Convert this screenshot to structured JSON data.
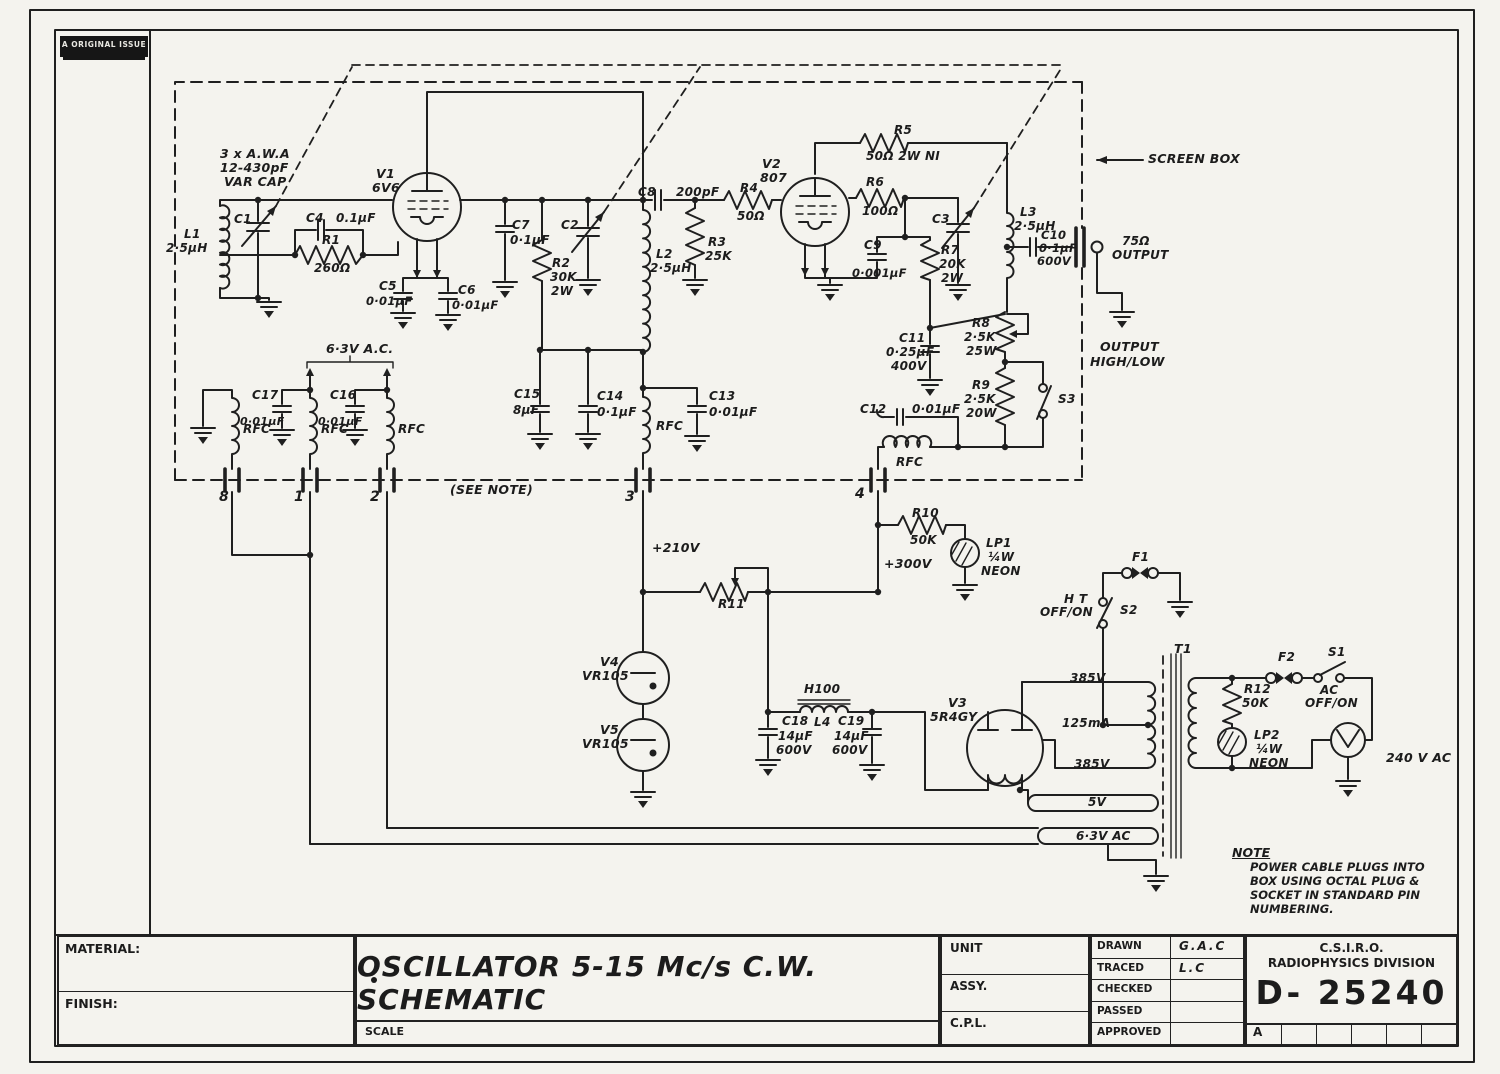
{
  "sheet": {
    "stamp": "A ORIGINAL ISSUE",
    "note": {
      "heading": "NOTE",
      "lines": [
        "POWER CABLE PLUGS INTO",
        "BOX USING OCTAL PLUG &",
        "SOCKET IN STANDARD PIN",
        "NUMBERING."
      ]
    },
    "title_block": {
      "material_label": "MATERIAL:",
      "finish_label": "FINISH:",
      "scale_label": "SCALE",
      "title": "OSCILLATOR  5-15 Mc/s C.W. SCHEMATIC",
      "unit_label": "UNIT",
      "assy_label": "ASSY.",
      "cpl_label": "C.P.L.",
      "rows": [
        {
          "label": "DRAWN",
          "value": "G.A.C"
        },
        {
          "label": "TRACED",
          "value": "L.C"
        },
        {
          "label": "CHECKED",
          "value": ""
        },
        {
          "label": "PASSED",
          "value": ""
        },
        {
          "label": "APPROVED",
          "value": ""
        }
      ],
      "org_line1": "C.S.I.R.O.",
      "org_line2": "RADIOPHYSICS DIVISION",
      "drawing_number": "D- 25240",
      "revision_cells": [
        "A",
        "",
        "",
        "",
        "",
        ""
      ]
    }
  },
  "schematic": {
    "labels": [
      {
        "t": "3 x A.W.A",
        "x": 220,
        "y": 148
      },
      {
        "t": "12-430pF",
        "x": 220,
        "y": 162
      },
      {
        "t": "VAR CAP",
        "x": 224,
        "y": 176
      },
      {
        "t": "V1",
        "x": 376,
        "y": 168
      },
      {
        "t": "6V6",
        "x": 372,
        "y": 182
      },
      {
        "t": "L1",
        "x": 184,
        "y": 228,
        "s": 12
      },
      {
        "t": "2·5μH",
        "x": 166,
        "y": 242,
        "s": 12
      },
      {
        "t": "C1",
        "x": 234,
        "y": 213,
        "s": 12
      },
      {
        "t": "C4",
        "x": 306,
        "y": 212,
        "s": 12
      },
      {
        "t": "0.1μF",
        "x": 336,
        "y": 212,
        "s": 12
      },
      {
        "t": "R1",
        "x": 322,
        "y": 234,
        "s": 12
      },
      {
        "t": "260Ω",
        "x": 314,
        "y": 262,
        "s": 12
      },
      {
        "t": "C5",
        "x": 379,
        "y": 280,
        "s": 12
      },
      {
        "t": "0·01μF",
        "x": 366,
        "y": 296,
        "s": 11.5
      },
      {
        "t": "C6",
        "x": 458,
        "y": 284,
        "s": 12
      },
      {
        "t": "0·01μF",
        "x": 452,
        "y": 300,
        "s": 11.5
      },
      {
        "t": "C7",
        "x": 512,
        "y": 219,
        "s": 12
      },
      {
        "t": "0·1μF",
        "x": 510,
        "y": 234,
        "s": 12
      },
      {
        "t": "C2",
        "x": 561,
        "y": 219,
        "s": 12
      },
      {
        "t": "R2",
        "x": 552,
        "y": 257,
        "s": 12
      },
      {
        "t": "30K",
        "x": 550,
        "y": 271,
        "s": 12
      },
      {
        "t": "2W",
        "x": 551,
        "y": 285,
        "s": 12
      },
      {
        "t": "L2",
        "x": 656,
        "y": 248,
        "s": 12
      },
      {
        "t": "2·5μH",
        "x": 650,
        "y": 262,
        "s": 12
      },
      {
        "t": "C8",
        "x": 638,
        "y": 186,
        "s": 12
      },
      {
        "t": "200pF",
        "x": 676,
        "y": 186,
        "s": 12
      },
      {
        "t": "R3",
        "x": 708,
        "y": 236,
        "s": 12
      },
      {
        "t": "25K",
        "x": 705,
        "y": 250,
        "s": 12
      },
      {
        "t": "R4",
        "x": 740,
        "y": 182,
        "s": 12
      },
      {
        "t": "50Ω",
        "x": 737,
        "y": 210,
        "s": 12
      },
      {
        "t": "V2",
        "x": 762,
        "y": 158
      },
      {
        "t": "807",
        "x": 760,
        "y": 172
      },
      {
        "t": "R5",
        "x": 894,
        "y": 124,
        "s": 12
      },
      {
        "t": "50Ω 2W NI",
        "x": 866,
        "y": 150,
        "s": 12
      },
      {
        "t": "R6",
        "x": 866,
        "y": 176,
        "s": 12
      },
      {
        "t": "100Ω",
        "x": 862,
        "y": 205,
        "s": 12
      },
      {
        "t": "C9",
        "x": 864,
        "y": 239,
        "s": 12
      },
      {
        "t": "0·001μF",
        "x": 852,
        "y": 268,
        "s": 11.5
      },
      {
        "t": "R7",
        "x": 941,
        "y": 244,
        "s": 12
      },
      {
        "t": "20K",
        "x": 939,
        "y": 258,
        "s": 12
      },
      {
        "t": "2W",
        "x": 941,
        "y": 272,
        "s": 12
      },
      {
        "t": "C3",
        "x": 932,
        "y": 213,
        "s": 12
      },
      {
        "t": "L3",
        "x": 1020,
        "y": 206,
        "s": 12
      },
      {
        "t": "2·5μH",
        "x": 1014,
        "y": 220,
        "s": 12
      },
      {
        "t": "C10",
        "x": 1041,
        "y": 230,
        "s": 11.5
      },
      {
        "t": "0·1μF",
        "x": 1039,
        "y": 243,
        "s": 11.5
      },
      {
        "t": "600V",
        "x": 1037,
        "y": 256,
        "s": 11.5
      },
      {
        "t": "75Ω",
        "x": 1122,
        "y": 235,
        "s": 12
      },
      {
        "t": "OUTPUT",
        "x": 1112,
        "y": 249,
        "s": 12
      },
      {
        "t": "SCREEN BOX",
        "x": 1148,
        "y": 153
      },
      {
        "t": "C11",
        "x": 899,
        "y": 332,
        "s": 12
      },
      {
        "t": "0·25μF",
        "x": 886,
        "y": 346,
        "s": 12
      },
      {
        "t": "400V",
        "x": 891,
        "y": 360,
        "s": 12
      },
      {
        "t": "R8",
        "x": 972,
        "y": 317,
        "s": 12
      },
      {
        "t": "2·5K",
        "x": 964,
        "y": 331,
        "s": 12
      },
      {
        "t": "25W",
        "x": 966,
        "y": 345,
        "s": 12
      },
      {
        "t": "R9",
        "x": 972,
        "y": 379,
        "s": 12
      },
      {
        "t": "2·5K",
        "x": 964,
        "y": 393,
        "s": 12
      },
      {
        "t": "20W",
        "x": 966,
        "y": 407,
        "s": 12
      },
      {
        "t": "S3",
        "x": 1058,
        "y": 393,
        "s": 12
      },
      {
        "t": "OUTPUT",
        "x": 1100,
        "y": 341
      },
      {
        "t": "HIGH/LOW",
        "x": 1090,
        "y": 356
      },
      {
        "t": "C12",
        "x": 860,
        "y": 403,
        "s": 12
      },
      {
        "t": "0·01μF",
        "x": 912,
        "y": 403,
        "s": 12
      },
      {
        "t": "RFC",
        "x": 896,
        "y": 456,
        "s": 12
      },
      {
        "t": "8",
        "x": 219,
        "y": 490,
        "s": 14
      },
      {
        "t": "1",
        "x": 294,
        "y": 490,
        "s": 14
      },
      {
        "t": "2",
        "x": 370,
        "y": 490,
        "s": 14
      },
      {
        "t": "3",
        "x": 625,
        "y": 490,
        "s": 14
      },
      {
        "t": "4",
        "x": 855,
        "y": 487,
        "s": 14
      },
      {
        "t": "(SEE NOTE)",
        "x": 450,
        "y": 484
      },
      {
        "t": "RFC",
        "x": 243,
        "y": 423,
        "s": 12
      },
      {
        "t": "RFC",
        "x": 321,
        "y": 423,
        "s": 12
      },
      {
        "t": "RFC",
        "x": 398,
        "y": 423,
        "s": 12
      },
      {
        "t": "RFC",
        "x": 656,
        "y": 420,
        "s": 12
      },
      {
        "t": "C17",
        "x": 252,
        "y": 389,
        "s": 12
      },
      {
        "t": "0·01μF",
        "x": 240,
        "y": 416,
        "s": 11
      },
      {
        "t": "C16",
        "x": 330,
        "y": 389,
        "s": 12
      },
      {
        "t": "0·01μF",
        "x": 318,
        "y": 416,
        "s": 11
      },
      {
        "t": "6·3V A.C.",
        "x": 326,
        "y": 343
      },
      {
        "t": "C15",
        "x": 514,
        "y": 388,
        "s": 12
      },
      {
        "t": "8μF",
        "x": 513,
        "y": 404,
        "s": 12
      },
      {
        "t": "C14",
        "x": 597,
        "y": 390,
        "s": 12
      },
      {
        "t": "0·1μF",
        "x": 597,
        "y": 406,
        "s": 12
      },
      {
        "t": "C13",
        "x": 709,
        "y": 390,
        "s": 12
      },
      {
        "t": "0·01μF",
        "x": 709,
        "y": 406,
        "s": 12
      },
      {
        "t": "+210V",
        "x": 652,
        "y": 542
      },
      {
        "t": "R10",
        "x": 912,
        "y": 507,
        "s": 12
      },
      {
        "t": "50K",
        "x": 910,
        "y": 534,
        "s": 12
      },
      {
        "t": "LP1",
        "x": 986,
        "y": 537,
        "s": 12
      },
      {
        "t": "¼W",
        "x": 988,
        "y": 551,
        "s": 12
      },
      {
        "t": "NEON",
        "x": 981,
        "y": 565,
        "s": 12
      },
      {
        "t": "+300V",
        "x": 884,
        "y": 558
      },
      {
        "t": "R11",
        "x": 718,
        "y": 598,
        "s": 12
      },
      {
        "t": "V4",
        "x": 600,
        "y": 656
      },
      {
        "t": "VR105",
        "x": 582,
        "y": 670
      },
      {
        "t": "V5",
        "x": 600,
        "y": 724
      },
      {
        "t": "VR105",
        "x": 582,
        "y": 738
      },
      {
        "t": "H100",
        "x": 804,
        "y": 683,
        "s": 12
      },
      {
        "t": "L4",
        "x": 814,
        "y": 716,
        "s": 12
      },
      {
        "t": "C18",
        "x": 782,
        "y": 715,
        "s": 12
      },
      {
        "t": "14μF",
        "x": 778,
        "y": 730,
        "s": 12
      },
      {
        "t": "600V",
        "x": 776,
        "y": 744,
        "s": 12
      },
      {
        "t": "C19",
        "x": 838,
        "y": 715,
        "s": 12
      },
      {
        "t": "14μF",
        "x": 834,
        "y": 730,
        "s": 12
      },
      {
        "t": "600V",
        "x": 832,
        "y": 744,
        "s": 12
      },
      {
        "t": "V3",
        "x": 948,
        "y": 697
      },
      {
        "t": "5R4GY",
        "x": 930,
        "y": 711
      },
      {
        "t": "T1",
        "x": 1174,
        "y": 643
      },
      {
        "t": "385V",
        "x": 1070,
        "y": 672,
        "s": 12
      },
      {
        "t": "125mA",
        "x": 1062,
        "y": 717,
        "s": 12
      },
      {
        "t": "385V",
        "x": 1074,
        "y": 758,
        "s": 12
      },
      {
        "t": "5V",
        "x": 1088,
        "y": 796,
        "s": 12
      },
      {
        "t": "6·3V AC",
        "x": 1076,
        "y": 830,
        "s": 12
      },
      {
        "t": "F1",
        "x": 1132,
        "y": 551,
        "s": 12
      },
      {
        "t": "S2",
        "x": 1120,
        "y": 604,
        "s": 12
      },
      {
        "t": "H T",
        "x": 1064,
        "y": 593,
        "s": 12
      },
      {
        "t": "OFF/ON",
        "x": 1040,
        "y": 606,
        "s": 12
      },
      {
        "t": "F2",
        "x": 1278,
        "y": 651,
        "s": 12
      },
      {
        "t": "S1",
        "x": 1328,
        "y": 646,
        "s": 12
      },
      {
        "t": "AC",
        "x": 1320,
        "y": 684,
        "s": 12
      },
      {
        "t": "OFF/ON",
        "x": 1305,
        "y": 697,
        "s": 12
      },
      {
        "t": "R12",
        "x": 1244,
        "y": 683,
        "s": 12
      },
      {
        "t": "50K",
        "x": 1242,
        "y": 697,
        "s": 12
      },
      {
        "t": "LP2",
        "x": 1254,
        "y": 729,
        "s": 12
      },
      {
        "t": "¼W",
        "x": 1256,
        "y": 743,
        "s": 12
      },
      {
        "t": "NEON",
        "x": 1249,
        "y": 757,
        "s": 12
      },
      {
        "t": "240 V AC",
        "x": 1386,
        "y": 752
      }
    ]
  }
}
